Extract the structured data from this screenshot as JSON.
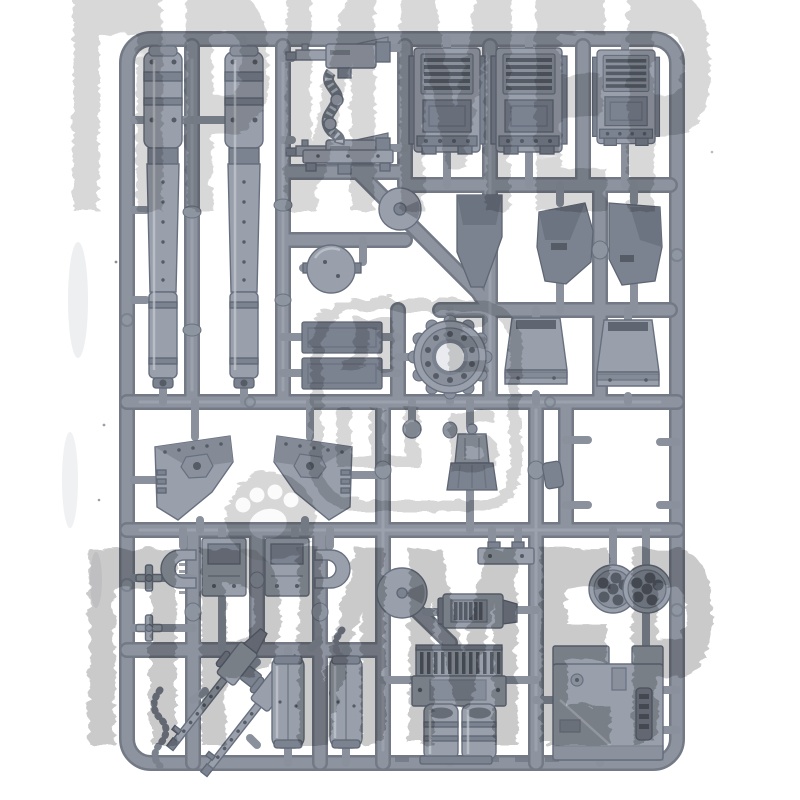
{
  "image_type": "product-photo",
  "scene": {
    "description": "Injection-moulded grey plastic model-kit sprue (tank / walker accessory frame) photographed on a plain white background. A large distressed grey watermark word is stamped across the top and bottom of the photo, and a faint rounded-square logo watermark with a paw print and illegible stacked glyphs sits in the centre.",
    "background_color": "#ffffff"
  },
  "sprue": {
    "plastic_base": "#99a0ab",
    "plastic_mid": "#8a919d",
    "plastic_dark": "#7b8290",
    "plastic_shadow": "#565c66",
    "rail_color": "#8d94a0",
    "parts": [
      {
        "name": "battle-cannon-barrel",
        "qty": 2,
        "desc": "long segmented gun barrels with muzzle brakes, top left"
      },
      {
        "name": "twin-autocannon-with-ammo-feed",
        "qty": 2,
        "desc": "two horizontal guns joined by a ribbed ammo belt, top middle"
      },
      {
        "name": "engine-louvre-block",
        "qty": 3,
        "desc": "vented engine blocks with horizontal louvres, top right"
      },
      {
        "name": "dark-armour-plate",
        "qty": 3,
        "desc": "dark faceted flat plates, upper right and centre"
      },
      {
        "name": "exhaust-stack-flare",
        "qty": 2,
        "desc": "flared bucket-shaped stack tops, mid right"
      },
      {
        "name": "pivot-disc",
        "qty": 1,
        "desc": "small disc on diagonal runner"
      },
      {
        "name": "dome-hatch",
        "qty": 1,
        "desc": "hemispherical hatch with side pins"
      },
      {
        "name": "mounting-platform",
        "qty": 1,
        "desc": "flat strip with feet"
      },
      {
        "name": "geared-ring",
        "qty": 1,
        "desc": "toothed turret ring with bolt circle, centre"
      },
      {
        "name": "flat-armour-panel",
        "qty": 2,
        "desc": "two stacked dark rectangular panels"
      },
      {
        "name": "track-guard-wing",
        "qty": 2,
        "desc": "mirrored angular plates with hexagonal boss, mid left"
      },
      {
        "name": "bracket-and-clamp",
        "qty": 2,
        "desc": "box with U-shaped clamp, mirrored pair"
      },
      {
        "name": "axle-cross",
        "qty": 2,
        "desc": "tiny cross-shaped axle joints on left rail"
      },
      {
        "name": "generator-torso",
        "qty": 1,
        "desc": "small flared generator / torso piece, centre right"
      },
      {
        "name": "ball-joint",
        "qty": 1,
        "desc": "small ball on stub"
      },
      {
        "name": "road-wheel",
        "qty": 1,
        "desc": "disc wheel on central runner, bottom middle"
      },
      {
        "name": "vented-gearbox",
        "qty": 1,
        "desc": "rectangular block with slatted grille"
      },
      {
        "name": "bracket-plate",
        "qty": 1,
        "desc": "small flat bracket with two lugs"
      },
      {
        "name": "radiator-engine",
        "qty": 1,
        "desc": "finned radiator over twin cylinders, bottom middle"
      },
      {
        "name": "six-barrel-missile-pod",
        "qty": 2,
        "desc": "round pods with multiple dark bores, bottom right"
      },
      {
        "name": "hull-panel",
        "qty": 1,
        "desc": "large stepped hull plate with hatch, bottom right corner"
      },
      {
        "name": "heavy-stubber",
        "qty": 2,
        "desc": "long perforated-barrel guns lying diagonally, bottom left"
      },
      {
        "name": "ammo-chain",
        "qty": 2,
        "desc": "hanging S-curved bead chains"
      },
      {
        "name": "fuel-drum-half",
        "qty": 2,
        "desc": "tall half-cylinder drum shells with flanges"
      }
    ]
  },
  "watermarks": {
    "top": {
      "text": "ПРИМЕР",
      "style": "huge distressed capitals, cropped by top edge",
      "color": "#9f9f9f"
    },
    "bottom": {
      "text": "ПРИМЕР",
      "style": "huge distressed capitals",
      "color": "#9a9a9a"
    },
    "center": {
      "shape": "rounded-square outline with paw print and stacked glyphs",
      "note": "glyphs are illegible in the photo; approximated",
      "glyphs": [
        "Л",
        "Е",
        "Ш",
        "Б"
      ],
      "color": "#b0b0b0"
    }
  }
}
